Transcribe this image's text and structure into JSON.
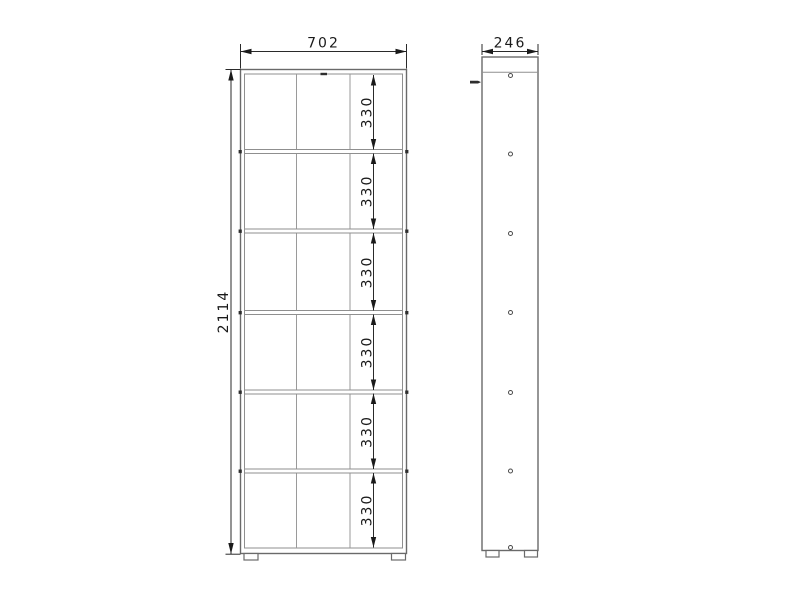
{
  "canvas": {
    "background": "#ffffff",
    "width_px": 800,
    "height_px": 600
  },
  "drawing": {
    "front_view": {
      "overall_width": "702",
      "overall_height": "2114",
      "compartment_heights": [
        "330",
        "330",
        "330",
        "330",
        "330",
        "330"
      ],
      "columns": 3,
      "shelf_count": 5,
      "feet_count": 2
    },
    "side_view": {
      "depth": "246",
      "pin_hole_count": 7,
      "feet_count": 2
    },
    "colors": {
      "background": "#ffffff",
      "object_line": "#6a6a6a",
      "internal_line": "#8f8f8f",
      "dimension_line": "#2a2a2a",
      "dimension_text": "#1a1a1a"
    }
  }
}
